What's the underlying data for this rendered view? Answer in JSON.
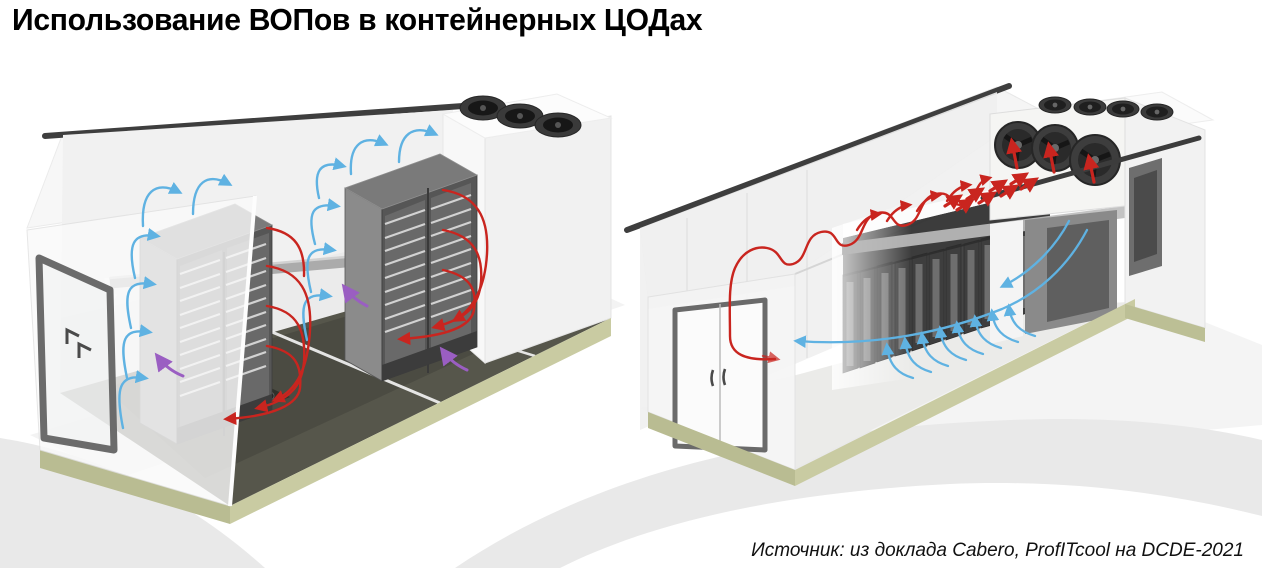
{
  "slide": {
    "title": "Использование ВОПов в контейнерных ЦОДах",
    "source_caption": "Источник: из доклада Cabero, ProfITcool на DCDE-2021"
  },
  "legend_colors": {
    "hot_air_flow": "#c9251f",
    "cold_air_flow": "#5fb2e2",
    "leakage_flow": "#9a5ec2",
    "container_plinth": "#c9cba2",
    "background_swoosh": "#e9e9e9"
  }
}
